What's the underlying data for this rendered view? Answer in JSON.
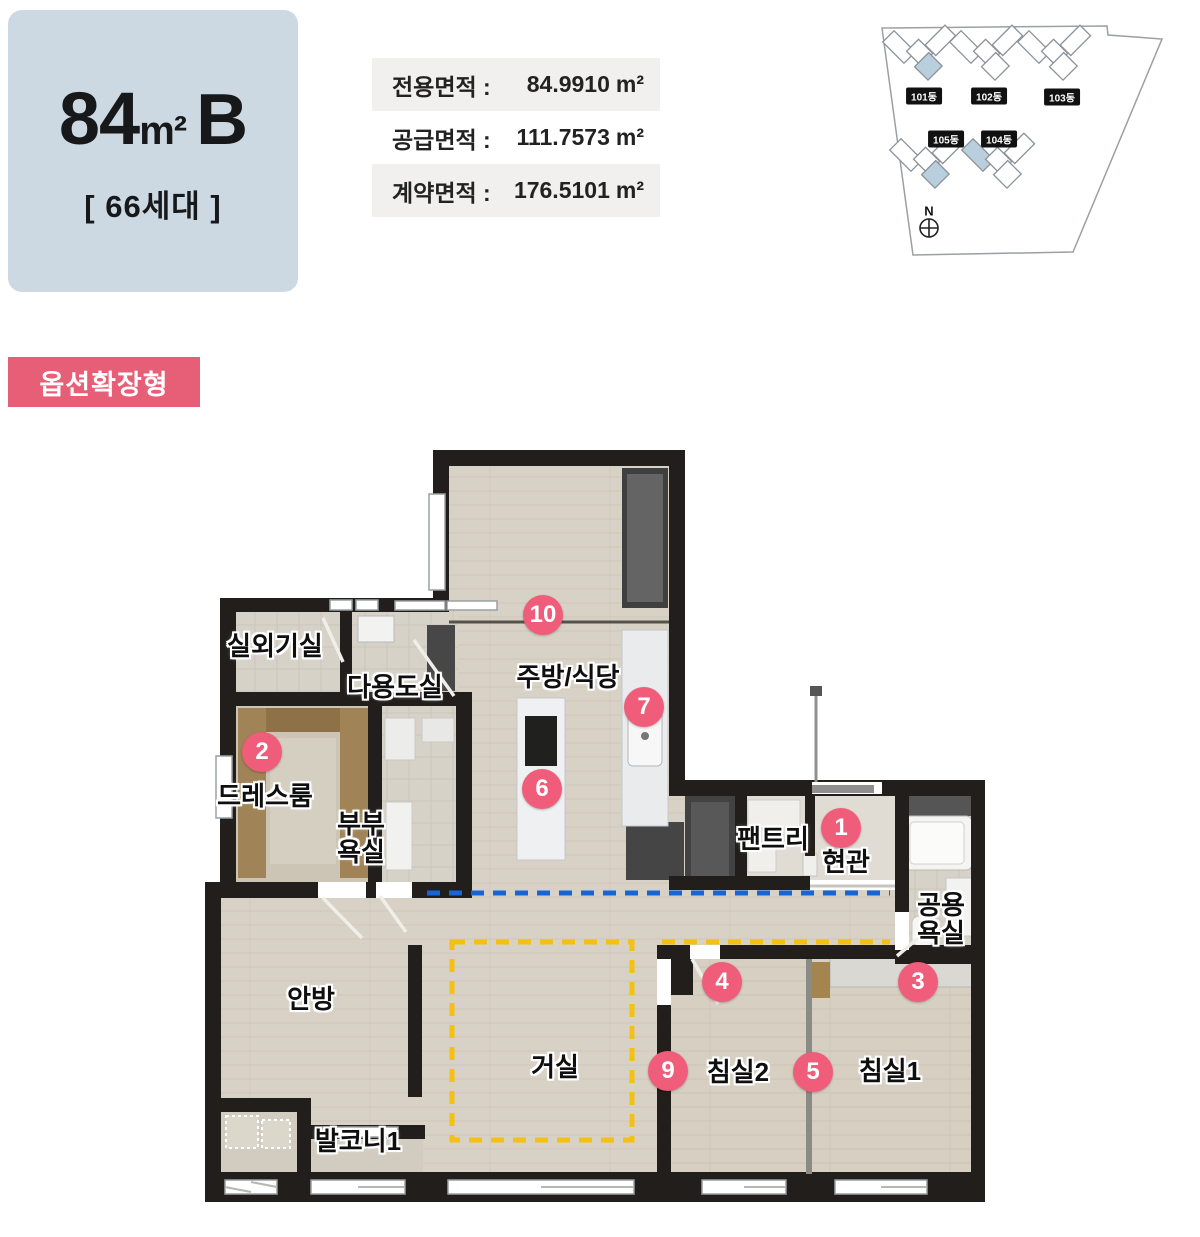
{
  "header": {
    "type_badge": {
      "size": "84",
      "unit": "m²",
      "type": "B",
      "household": "[ 66세대 ]"
    },
    "area_table": {
      "rows": [
        {
          "label": "전용면적 :",
          "value": "84.9910",
          "unit": "m²"
        },
        {
          "label": "공급면적 :",
          "value": "111.7573",
          "unit": "m²"
        },
        {
          "label": "계약면적 :",
          "value": "176.5101",
          "unit": "m²"
        }
      ]
    },
    "site_map": {
      "buildings": [
        {
          "label": "101동",
          "highlighted": true
        },
        {
          "label": "102동",
          "highlighted": false
        },
        {
          "label": "103동",
          "highlighted": false
        },
        {
          "label": "104동",
          "highlighted": true
        },
        {
          "label": "105동",
          "highlighted": true
        }
      ],
      "compass_label": "N"
    }
  },
  "option_tag": {
    "label": "옵션확장형"
  },
  "floor_plan": {
    "rooms": [
      {
        "label": "실외기실"
      },
      {
        "label": "다용도실"
      },
      {
        "label": "드레스룸"
      },
      {
        "lines": [
          "부부",
          "욕실"
        ]
      },
      {
        "label": "주방/식당"
      },
      {
        "label": "팬트리"
      },
      {
        "label": "현관"
      },
      {
        "lines": [
          "공용",
          "욕실"
        ]
      },
      {
        "label": "안방"
      },
      {
        "label": "거실"
      },
      {
        "label": "발코니1"
      },
      {
        "label": "침실2"
      },
      {
        "label": "침실1"
      }
    ],
    "markers": [
      {
        "number": "1"
      },
      {
        "number": "2"
      },
      {
        "number": "3"
      },
      {
        "number": "4"
      },
      {
        "number": "5"
      },
      {
        "number": "6"
      },
      {
        "number": "7"
      },
      {
        "number": "9"
      },
      {
        "number": "10"
      }
    ]
  },
  "colors": {
    "accent_pink": "#f05d7a",
    "tag_pink": "#e75f76",
    "badge_blue": "#ccd9e2",
    "wall": "#211e1b",
    "floor": "#d8d1c5",
    "building_highlight": "#b9cfde",
    "dash_blue": "#1565d8",
    "dash_yellow": "#f4c113"
  }
}
